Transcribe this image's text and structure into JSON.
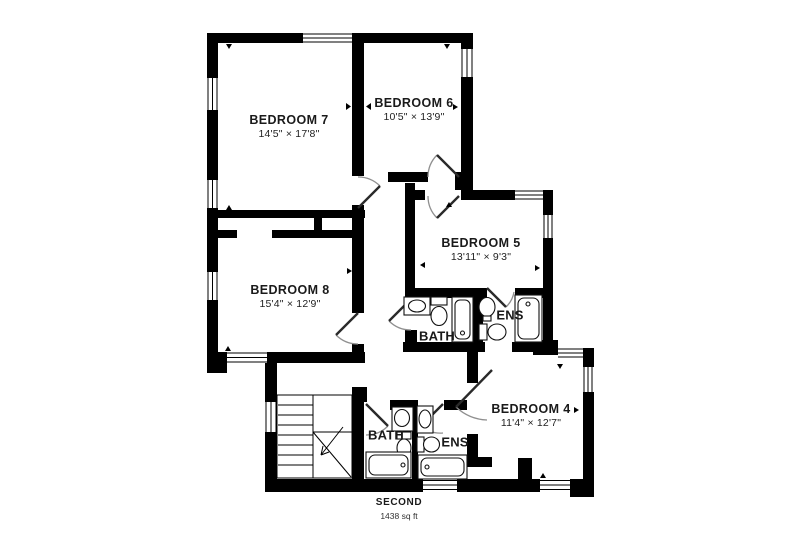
{
  "floor": {
    "name": "SECOND",
    "area": "1438 sq ft"
  },
  "rooms": {
    "bedroom7": {
      "name": "BEDROOM 7",
      "dims": "14'5\" × 17'8\""
    },
    "bedroom6": {
      "name": "BEDROOM 6",
      "dims": "10'5\" × 13'9\""
    },
    "bedroom5": {
      "name": "BEDROOM 5",
      "dims": "13'11\" × 9'3\""
    },
    "bedroom8": {
      "name": "BEDROOM 8",
      "dims": "15'4\" × 12'9\""
    },
    "bedroom4": {
      "name": "BEDROOM 4",
      "dims": "11'4\" × 12'7\""
    },
    "bath_upper": {
      "name": "BATH"
    },
    "ens_upper": {
      "name": "ENS"
    },
    "bath_lower": {
      "name": "BATH"
    },
    "ens_lower": {
      "name": "ENS"
    }
  },
  "colors": {
    "wall": "#000000",
    "background": "#ffffff",
    "door_leaf": "#2a2a2a",
    "door_arc": "#8f8f8f",
    "fixture_line": "#111111",
    "text": "#1a1a1a"
  }
}
